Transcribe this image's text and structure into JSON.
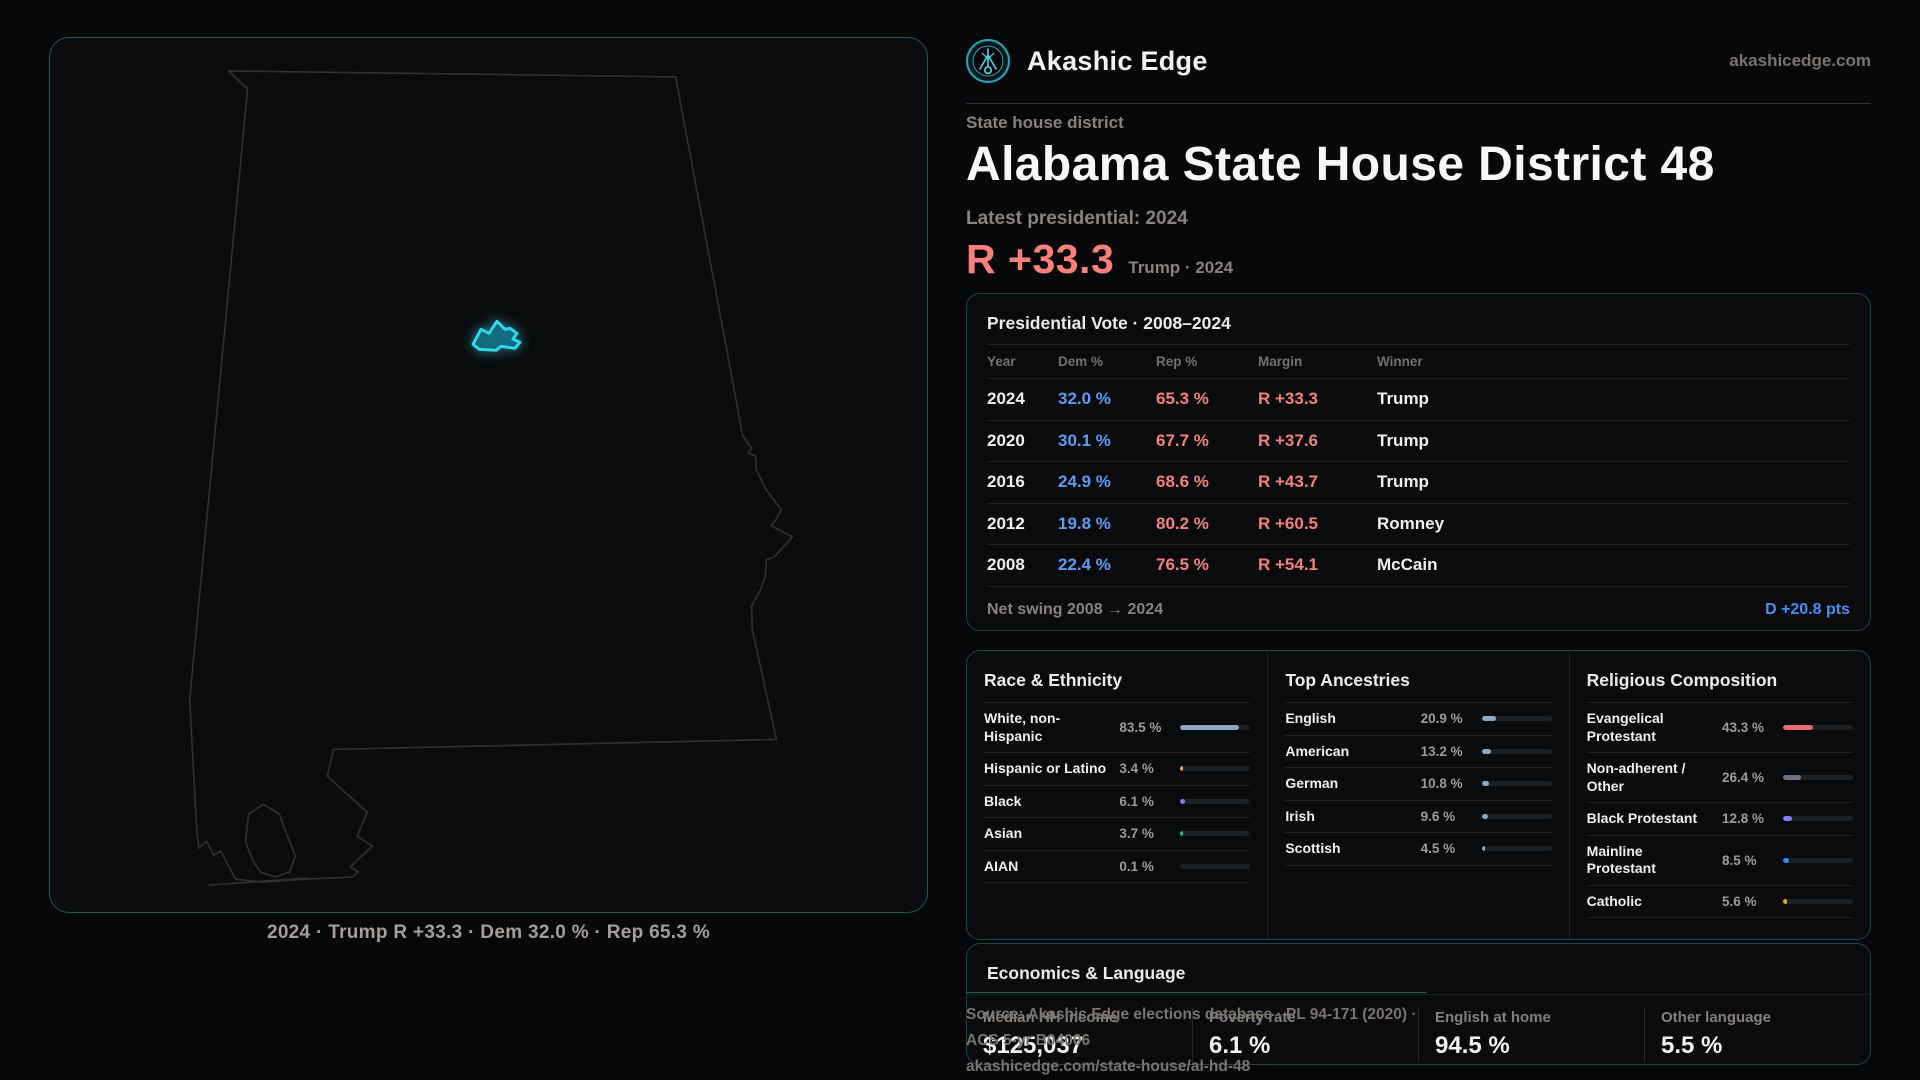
{
  "brand": {
    "name": "Akashic Edge",
    "domain": "akashicedge.com",
    "logo_icon": "akashic-edge-emblem",
    "accent_teal": "#2aa9bd"
  },
  "header": {
    "eyebrow": "State house district",
    "title": "Alabama State House District 48",
    "latest_label": "Latest presidential: 2024",
    "margin_value": "R +33.3",
    "margin_caption": "Trump · 2024",
    "margin_color": "#fa807b"
  },
  "map": {
    "caption": "2024 · Trump R +33.3 · Dem 32.0 % · Rep 65.3 %",
    "district_color": "#2fd8f0",
    "outline_color": "#33312f"
  },
  "presidential": {
    "title": "Presidential Vote · 2008–2024",
    "columns": [
      "Year",
      "Dem %",
      "Rep %",
      "Margin",
      "Winner"
    ],
    "rows": [
      {
        "year": "2024",
        "dem": "32.0 %",
        "rep": "65.3 %",
        "margin": "R +33.3",
        "winner": "Trump"
      },
      {
        "year": "2020",
        "dem": "30.1 %",
        "rep": "67.7 %",
        "margin": "R +37.6",
        "winner": "Trump"
      },
      {
        "year": "2016",
        "dem": "24.9 %",
        "rep": "68.6 %",
        "margin": "R +43.7",
        "winner": "Trump"
      },
      {
        "year": "2012",
        "dem": "19.8 %",
        "rep": "80.2 %",
        "margin": "R +60.5",
        "winner": "Romney"
      },
      {
        "year": "2008",
        "dem": "22.4 %",
        "rep": "76.5 %",
        "margin": "R +54.1",
        "winner": "McCain"
      }
    ],
    "dem_color": "#5b9cf7",
    "rep_color": "#f4817c",
    "footer_label": "Net swing 2008 → 2024",
    "footer_value": "D +20.8 pts",
    "footer_value_color": "#3f93f6"
  },
  "demographics": {
    "columns": [
      {
        "title": "Race & Ethnicity",
        "rows": [
          {
            "label": "White, non-Hispanic",
            "value": "83.5 %",
            "pct": 83.5,
            "color": "#93a9bf"
          },
          {
            "label": "Hispanic or Latino",
            "value": "3.4 %",
            "pct": 3.4,
            "color": "#f0a33c"
          },
          {
            "label": "Black",
            "value": "6.1 %",
            "pct": 6.1,
            "color": "#8a7cf2"
          },
          {
            "label": "Asian",
            "value": "3.7 %",
            "pct": 3.7,
            "color": "#25c08a"
          },
          {
            "label": "AIAN",
            "value": "0.1 %",
            "pct": 0.1,
            "color": "#93a9bf"
          }
        ]
      },
      {
        "title": "Top Ancestries",
        "rows": [
          {
            "label": "English",
            "value": "20.9 %",
            "pct": 20.9,
            "color": "#93a9bf"
          },
          {
            "label": "American",
            "value": "13.2 %",
            "pct": 13.2,
            "color": "#93a9bf"
          },
          {
            "label": "German",
            "value": "10.8 %",
            "pct": 10.8,
            "color": "#93a9bf"
          },
          {
            "label": "Irish",
            "value": "9.6 %",
            "pct": 9.6,
            "color": "#93a9bf"
          },
          {
            "label": "Scottish",
            "value": "4.5 %",
            "pct": 4.5,
            "color": "#93a9bf"
          }
        ]
      },
      {
        "title": "Religious Composition",
        "rows": [
          {
            "label": "Evangelical Protestant",
            "value": "43.3 %",
            "pct": 43.3,
            "color": "#e86c6c"
          },
          {
            "label": "Non-adherent / Other",
            "value": "26.4 %",
            "pct": 26.4,
            "color": "#6b7685"
          },
          {
            "label": "Black Protestant",
            "value": "12.8 %",
            "pct": 12.8,
            "color": "#8a7cf2"
          },
          {
            "label": "Mainline Protestant",
            "value": "8.5 %",
            "pct": 8.5,
            "color": "#3d87f5"
          },
          {
            "label": "Catholic",
            "value": "5.6 %",
            "pct": 5.6,
            "color": "#eab308"
          }
        ]
      }
    ]
  },
  "economics": {
    "title": "Economics & Language",
    "stats": [
      {
        "label": "Median HH income",
        "value": "$125,037"
      },
      {
        "label": "Poverty rate",
        "value": "6.1 %"
      },
      {
        "label": "English at home",
        "value": "94.5 %"
      },
      {
        "label": "Other language",
        "value": "5.5 %"
      }
    ]
  },
  "source": {
    "line1": "Source: Akashic Edge elections database · PL 94-171 (2020) · ACS 5-yr B04006",
    "line2": "akashicedge.com/state-house/al-hd-48"
  }
}
